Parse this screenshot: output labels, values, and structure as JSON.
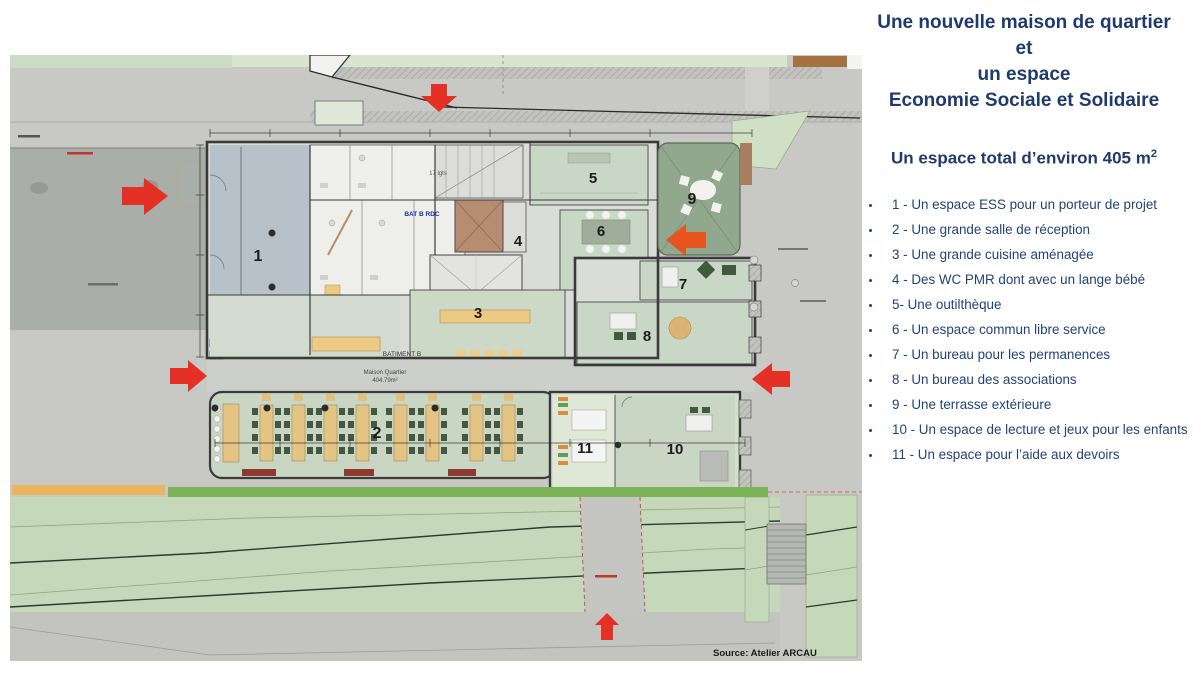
{
  "panel": {
    "title_lines": [
      "Une nouvelle maison de quartier",
      "et",
      "un espace",
      "Economie Sociale et Solidaire"
    ],
    "subtitle": {
      "text": "Un espace total d’environ 405 m",
      "sup": "2"
    },
    "items": [
      "1 - Un espace ESS pour un porteur de projet",
      "2 - Une grande salle de réception",
      "3 - Une grande cuisine aménagée",
      "4 - Des WC PMR dont avec un lange bébé",
      "5- Une outilthèque",
      "6 - Un espace commun libre service",
      "7 - Un bureau pour les permanences",
      "8 - Un bureau des associations",
      "9 - Une terrasse extérieure",
      "10 - Un espace de lecture et jeux pour les enfants",
      "11 - Un espace pour l’aide aux devoirs"
    ],
    "colors": {
      "title": "#1f3a6e",
      "text": "#24427a",
      "arrow_red": "#e53026"
    }
  },
  "plan": {
    "source": "Source: Atelier ARCAU",
    "labels": {
      "batiment_b": "BATIMENT B",
      "maison_quartier": "Maison Quartier",
      "area": "404.79m²",
      "bat_b_rdc": "BAT B RDC",
      "lgts": "17 lgts"
    },
    "rooms": [
      "1",
      "2",
      "3",
      "4",
      "5",
      "6",
      "7",
      "8",
      "9",
      "10",
      "11"
    ]
  }
}
